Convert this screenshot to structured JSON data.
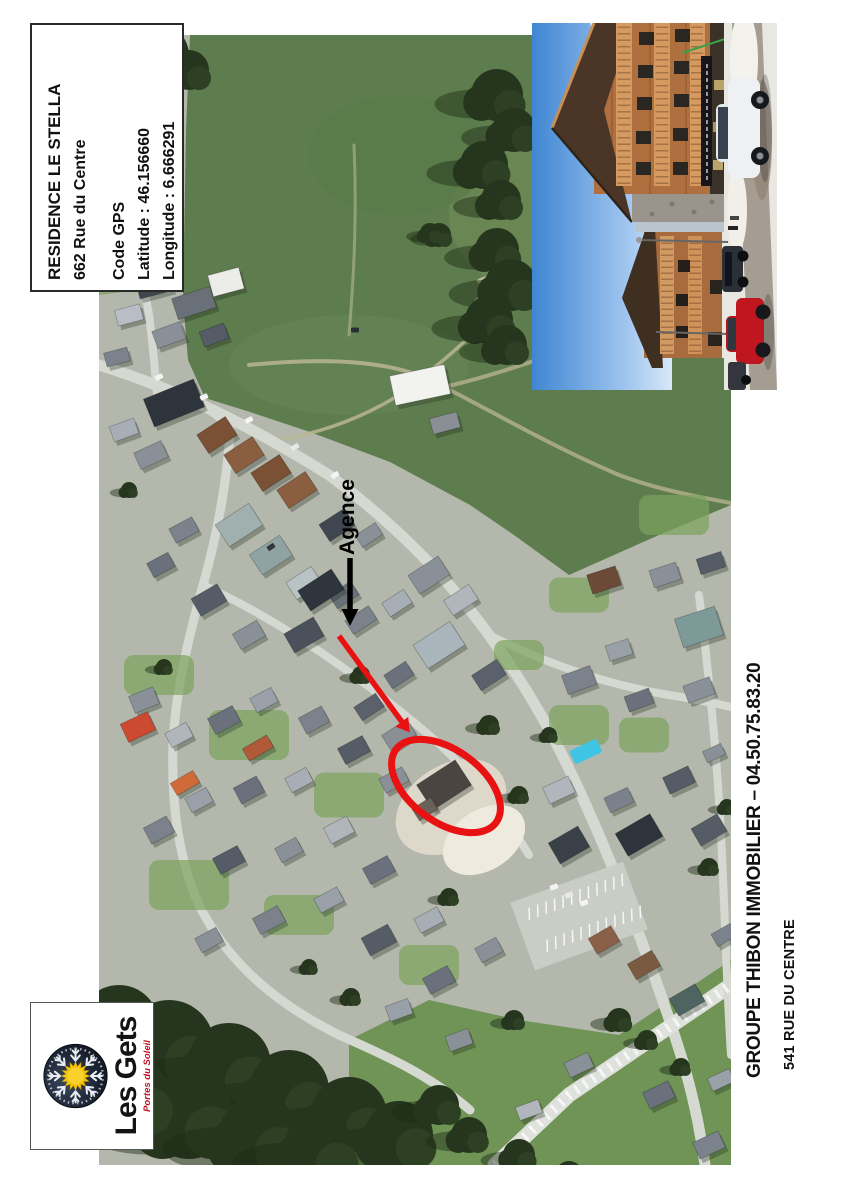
{
  "document": {
    "info_box": {
      "title": "RESIDENCE LE STELLA",
      "address": "662 Rue du Centre",
      "gps_heading": "Code GPS",
      "latitude": "Latitude : 46.156660",
      "longitude": "Longitude : 6.666291"
    },
    "map": {
      "agence_label": "Agence"
    },
    "logo": {
      "name": "Les Gets",
      "tagline": "Portes du Soleil"
    },
    "footer": {
      "line1": "GROUPE THIBON IMMOBILIER – 04.50.75.83.20",
      "line2": "541 RUE DU CENTRE"
    },
    "colors": {
      "annotation_red": "#e81212",
      "annotation_black": "#000000",
      "field_green": "#5e7d4e",
      "meadow_green": "#6f9456",
      "tree_green": "#26351d",
      "village_ground": "#b4b8ac",
      "road_gray": "#d6d9d2",
      "sky_blue": "#3f86d2",
      "logo_sun_yellow": "#f4c411",
      "logo_circle_dark": "#1a2230",
      "logo_tagline_red": "#c41020"
    }
  }
}
